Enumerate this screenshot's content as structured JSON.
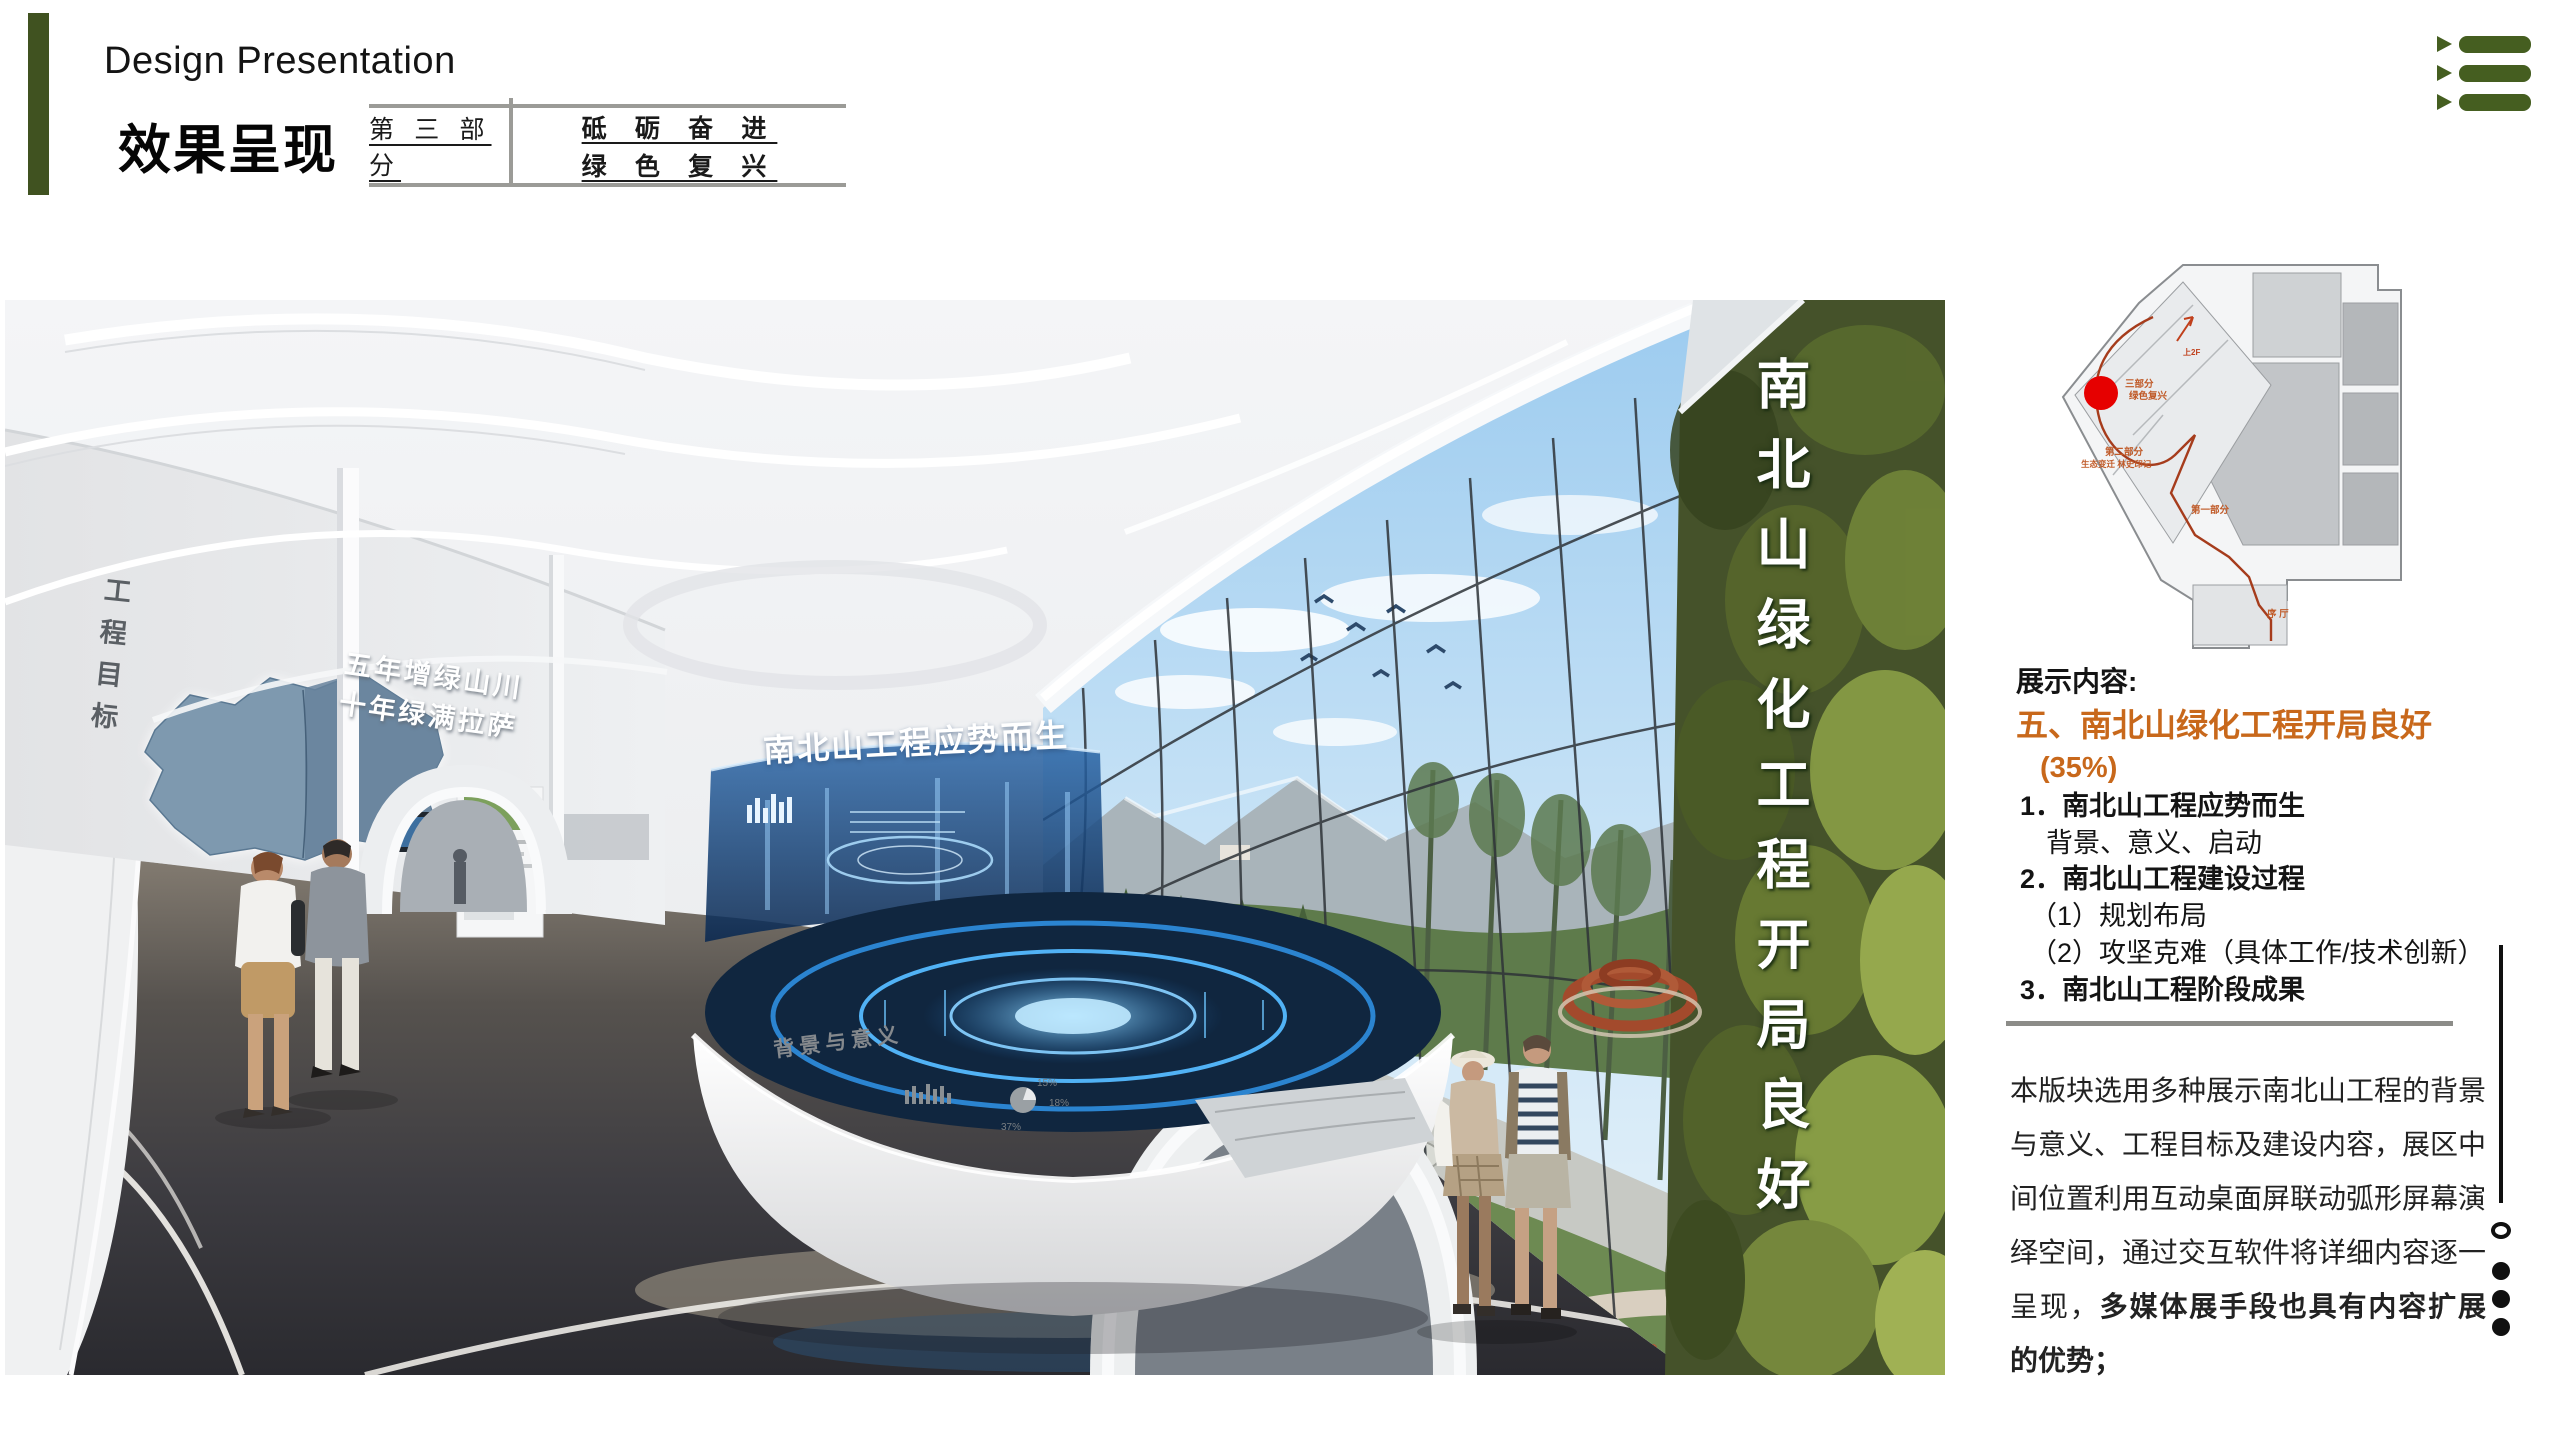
{
  "header": {
    "title_en": "Design Presentation",
    "title_cn": "效果呈现",
    "part_label": "第 三 部 分",
    "slogan_line1": "砥 砺 奋 进",
    "slogan_line2": "绿 色 复 兴",
    "accent_green": "#405220"
  },
  "menu_icon_color": "#455e20",
  "render": {
    "greenwall_text": "南北山绿化工程开局良好",
    "left_wall_label": "工程目标",
    "map_caption_line1": "五年增绿山川",
    "map_caption_line2": "十年绿满拉萨",
    "holo_title": "南北山工程应势而生",
    "table_rim_label": "背景与意义",
    "table_pie_37": "37%",
    "table_pie_18": "18%",
    "table_pie_15": "15%"
  },
  "floorplan": {
    "label_up": "上2F",
    "label_part3_l1": "三部分",
    "label_part3_l2": "绿色复兴",
    "label_part2": "第二部分",
    "label_part2_sub": "生态变迁 林史印记",
    "label_part1": "第一部分",
    "label_lobby": "序 厅",
    "marker_color": "#e60000",
    "route_color": "#a63c1c"
  },
  "sidebar": {
    "section_label": "展示内容:",
    "heading": "五、南北山绿化工程开局良好",
    "percent": "(35%)",
    "item1": "1．南北山工程应势而生",
    "item1_sub": "背景、意义、启动",
    "item2": "2．南北山工程建设过程",
    "item2_sub1": "（1）规划布局",
    "item2_sub2": "（2）攻坚克难（具体工作/技术创新）",
    "item3": "3．南北山工程阶段成果",
    "paragraph_normal": "本版块选用多种展示南北山工程的背景与意义、工程目标及建设内容，展区中间位置利用互动桌面屏联动弧形屏幕演绎空间，通过交互软件将详细内容逐一呈现，",
    "paragraph_bold": "多媒体展手段也具有内容扩展的优势；",
    "accent_orange": "#c8681b"
  }
}
